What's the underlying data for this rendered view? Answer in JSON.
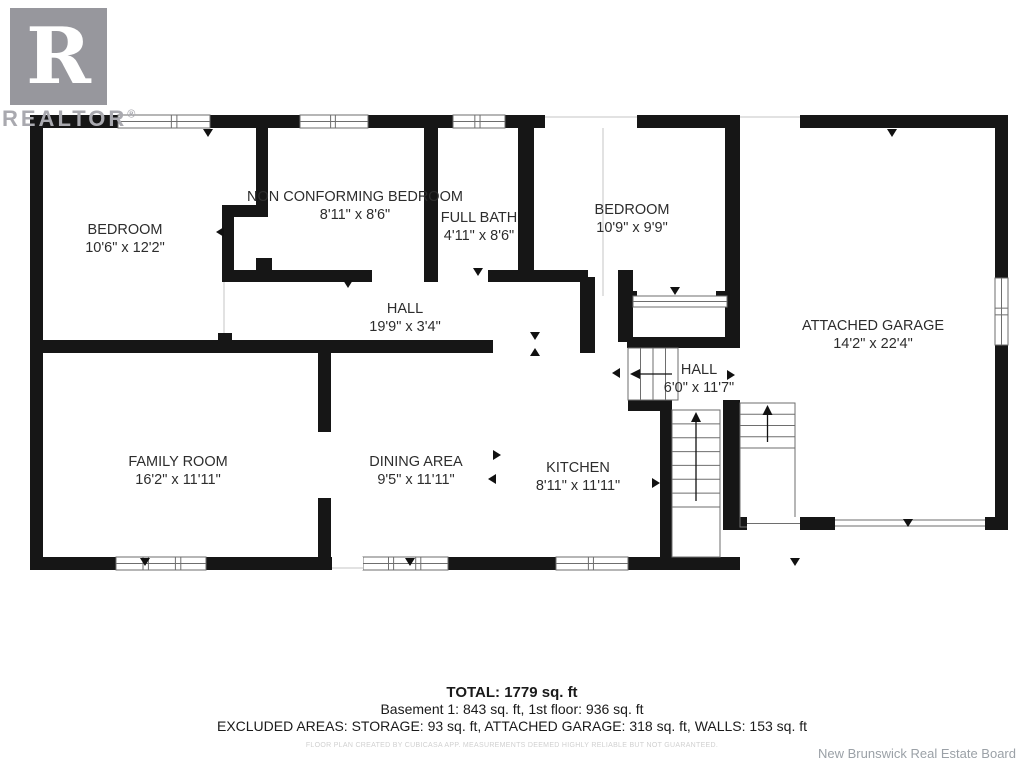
{
  "branding": {
    "logo_letter": "R",
    "logo_text": "REALTOR",
    "registered": "®",
    "board_credit": "New Brunswick Real Estate Board"
  },
  "summary": {
    "total": "TOTAL: 1779 sq. ft",
    "floors": "Basement 1: 843 sq. ft, 1st floor: 936 sq. ft",
    "excluded": "EXCLUDED AREAS: STORAGE: 93 sq. ft, ATTACHED GARAGE: 318 sq. ft, WALLS: 153 sq. ft",
    "disclaimer": "FLOOR PLAN CREATED BY CUBICASA APP. MEASUREMENTS DEEMED HIGHLY RELIABLE BUT NOT GUARANTEED."
  },
  "colors": {
    "wall": "#161616",
    "thin": "#6e6e6e",
    "faint": "#c6c6c6",
    "label": "#2d2d2d",
    "logo_gray": "#97979d"
  },
  "floorplan": {
    "rooms": [
      {
        "id": "bedroom-left",
        "name": "BEDROOM",
        "dims": "10'6\" x 12'2\"",
        "cx": 125,
        "cy": 234
      },
      {
        "id": "non-conforming-bedroom",
        "name": "NON CONFORMING BEDROOM",
        "dims": "8'11\" x 8'6\"",
        "cx": 355,
        "cy": 201
      },
      {
        "id": "full-bath",
        "name": "FULL BATH",
        "dims": "4'11\" x 8'6\"",
        "cx": 479,
        "cy": 222
      },
      {
        "id": "bedroom-right",
        "name": "BEDROOM",
        "dims": "10'9\" x 9'9\"",
        "cx": 632,
        "cy": 214
      },
      {
        "id": "attached-garage",
        "name": "ATTACHED GARAGE",
        "dims": "14'2\" x 22'4\"",
        "cx": 873,
        "cy": 330
      },
      {
        "id": "hall-main",
        "name": "HALL",
        "dims": "19'9\" x 3'4\"",
        "cx": 405,
        "cy": 313
      },
      {
        "id": "hall-upper",
        "name": "HALL",
        "dims": "6'0\" x 11'7\"",
        "cx": 699,
        "cy": 374
      },
      {
        "id": "family-room",
        "name": "FAMILY ROOM",
        "dims": "16'2\" x 11'11\"",
        "cx": 178,
        "cy": 466
      },
      {
        "id": "dining-area",
        "name": "DINING AREA",
        "dims": "9'5\" x 11'11\"",
        "cx": 416,
        "cy": 466
      },
      {
        "id": "kitchen",
        "name": "KITCHEN",
        "dims": "8'11\" x 11'11\"",
        "cx": 578,
        "cy": 472
      }
    ],
    "walls": [
      [
        30,
        115,
        88,
        13
      ],
      [
        210,
        115,
        90,
        13
      ],
      [
        368,
        115,
        85,
        13
      ],
      [
        505,
        115,
        40,
        13
      ],
      [
        637,
        115,
        103,
        13
      ],
      [
        800,
        115,
        208,
        13
      ],
      [
        30,
        115,
        13,
        455
      ],
      [
        30,
        557,
        86,
        13
      ],
      [
        206,
        557,
        126,
        13
      ],
      [
        448,
        557,
        108,
        13
      ],
      [
        628,
        557,
        112,
        13
      ],
      [
        256,
        128,
        12,
        85
      ],
      [
        222,
        205,
        46,
        12
      ],
      [
        222,
        205,
        12,
        77
      ],
      [
        222,
        270,
        150,
        12
      ],
      [
        256,
        258,
        16,
        12
      ],
      [
        424,
        270,
        14,
        12
      ],
      [
        488,
        270,
        100,
        12
      ],
      [
        424,
        128,
        14,
        142
      ],
      [
        518,
        128,
        16,
        142
      ],
      [
        580,
        277,
        15,
        76
      ],
      [
        618,
        270,
        15,
        72
      ],
      [
        627,
        291,
        10,
        16
      ],
      [
        716,
        291,
        14,
        16
      ],
      [
        627,
        337,
        100,
        11
      ],
      [
        218,
        333,
        14,
        12
      ],
      [
        30,
        340,
        463,
        13
      ],
      [
        318,
        340,
        13,
        92
      ],
      [
        318,
        498,
        13,
        72
      ],
      [
        660,
        400,
        12,
        170
      ],
      [
        628,
        400,
        44,
        11
      ],
      [
        725,
        128,
        15,
        220
      ],
      [
        723,
        400,
        17,
        130
      ],
      [
        737,
        517,
        10,
        13
      ],
      [
        800,
        517,
        35,
        13
      ],
      [
        985,
        517,
        23,
        13
      ],
      [
        995,
        128,
        13,
        150
      ],
      [
        995,
        345,
        13,
        185
      ]
    ],
    "windows": [
      {
        "x": 118,
        "y": 115,
        "w": 92,
        "h": 13,
        "o": "h",
        "div": [
          0.58,
          0.64
        ]
      },
      {
        "x": 300,
        "y": 115,
        "w": 68,
        "h": 13,
        "o": "h",
        "div": [
          0.45,
          0.52
        ]
      },
      {
        "x": 453,
        "y": 115,
        "w": 52,
        "h": 13,
        "o": "h",
        "div": [
          0.42,
          0.52
        ]
      },
      {
        "x": 116,
        "y": 557,
        "w": 90,
        "h": 13,
        "o": "h",
        "div": [
          0.3,
          0.36,
          0.66,
          0.72
        ]
      },
      {
        "x": 363,
        "y": 557,
        "w": 85,
        "h": 13,
        "o": "h",
        "div": [
          0.3,
          0.36,
          0.62,
          0.68
        ]
      },
      {
        "x": 556,
        "y": 557,
        "w": 72,
        "h": 13,
        "o": "h",
        "div": [
          0.45,
          0.52
        ]
      },
      {
        "x": 995,
        "y": 278,
        "w": 13,
        "h": 67,
        "o": "v",
        "div": [
          0.45,
          0.55
        ]
      },
      {
        "x": 633,
        "y": 296,
        "w": 94,
        "h": 11,
        "o": "h",
        "div": []
      }
    ],
    "openings": [
      {
        "x": 545,
        "y": 115,
        "w": 92,
        "h": 13,
        "side": "top"
      },
      {
        "x": 740,
        "y": 115,
        "w": 60,
        "h": 13,
        "side": "top"
      },
      {
        "x": 332,
        "y": 557,
        "w": 31,
        "h": 13,
        "side": "bottom"
      },
      {
        "x": 222,
        "y": 282,
        "w": 12,
        "h": 51,
        "side": "left"
      },
      {
        "x": 747,
        "y": 517,
        "w": 53,
        "h": 13,
        "side": "center-h"
      },
      {
        "x": 835,
        "y": 517,
        "w": 150,
        "h": 13,
        "side": "double-h"
      }
    ],
    "outline_rects": [
      [
        740,
        403,
        55,
        124
      ],
      [
        672,
        410,
        48,
        147
      ]
    ],
    "lines": [
      [
        603,
        128,
        603,
        296
      ]
    ],
    "stairs": [
      {
        "id": "basement-stairs-main",
        "x": 672,
        "y": 410,
        "w": 48,
        "h": 97,
        "o": "v",
        "treads": 6,
        "arrow": "up"
      },
      {
        "id": "basement-stairs-upper",
        "x": 628,
        "y": 348,
        "w": 50,
        "h": 52,
        "o": "h",
        "treads": 3,
        "arrow": "left"
      },
      {
        "id": "garage-steps",
        "x": 740,
        "y": 403,
        "w": 55,
        "h": 45,
        "o": "v",
        "treads": 3,
        "arrow": "up"
      }
    ],
    "markers": [
      {
        "x": 208,
        "y": 133,
        "d": "down"
      },
      {
        "x": 348,
        "y": 284,
        "d": "down"
      },
      {
        "x": 478,
        "y": 272,
        "d": "down"
      },
      {
        "x": 535,
        "y": 336,
        "d": "down"
      },
      {
        "x": 535,
        "y": 352,
        "d": "up"
      },
      {
        "x": 675,
        "y": 291,
        "d": "down"
      },
      {
        "x": 892,
        "y": 133,
        "d": "down"
      },
      {
        "x": 908,
        "y": 523,
        "d": "down"
      },
      {
        "x": 497,
        "y": 455,
        "d": "right"
      },
      {
        "x": 492,
        "y": 479,
        "d": "left"
      },
      {
        "x": 616,
        "y": 373,
        "d": "left"
      },
      {
        "x": 731,
        "y": 375,
        "d": "right"
      },
      {
        "x": 220,
        "y": 232,
        "d": "left"
      },
      {
        "x": 145,
        "y": 562,
        "d": "down"
      },
      {
        "x": 410,
        "y": 562,
        "d": "down"
      },
      {
        "x": 795,
        "y": 562,
        "d": "down"
      },
      {
        "x": 656,
        "y": 483,
        "d": "right"
      }
    ]
  }
}
